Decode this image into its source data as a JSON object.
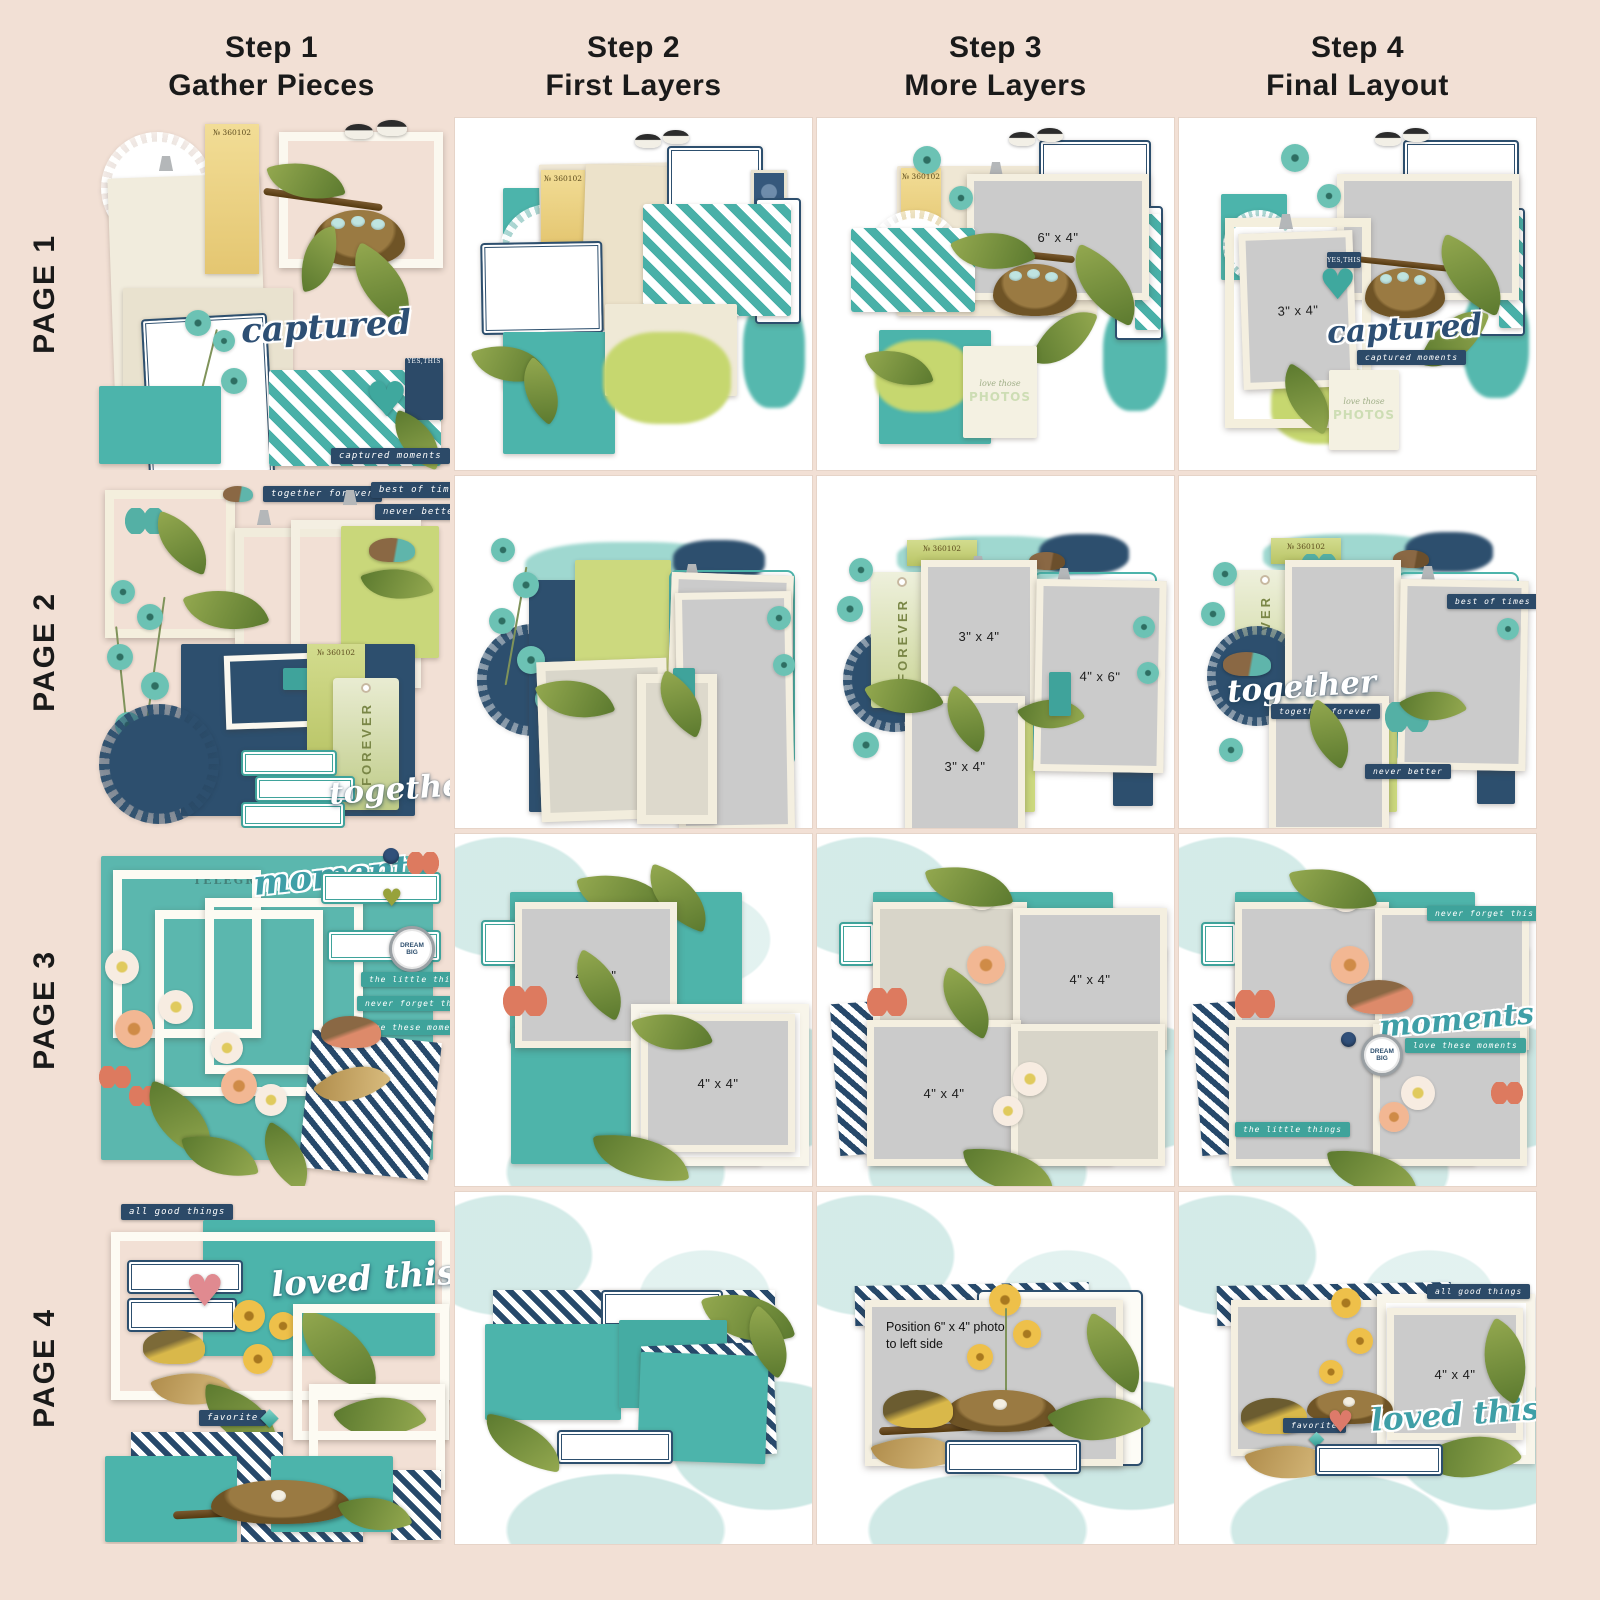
{
  "headers": [
    {
      "step": "Step 1",
      "title": "Gather Pieces"
    },
    {
      "step": "Step 2",
      "title": "First Layers"
    },
    {
      "step": "Step 3",
      "title": "More Layers"
    },
    {
      "step": "Step 4",
      "title": "Final Layout"
    }
  ],
  "row_labels": [
    "PAGE 1",
    "PAGE 2",
    "PAGE 3",
    "PAGE 4"
  ],
  "photo_sizes": {
    "s64": "6\" x 4\"",
    "s34": "3\" x 4\"",
    "s46": "4\" x 6\"",
    "s44": "4\" x 4\""
  },
  "strings": {
    "ticket_no": "№ 360102",
    "captured": "captured",
    "captured_moments": "captured moments",
    "yes_this": "YES,THIS",
    "love_those": "love those",
    "photos": "PHOTOS",
    "together": "together",
    "together_forever": "together forever",
    "best_of_times": "best of times",
    "never_better": "never better",
    "forever": "FOREVER",
    "moments": "moments",
    "little_things": "the little things",
    "never_forget": "never forget this",
    "love_these_moments": "love these moments",
    "dream_big": "DREAM BIG",
    "telegram": "TELEGRAMM",
    "all_good_things": "all good things",
    "loved_this": "loved this",
    "favorite": "favorite",
    "position_note": "Position 6\" x 4\" photo to left side"
  },
  "colors": {
    "background": "#f2e0d5",
    "teal": "#4cb3aa",
    "navy": "#2d4a66",
    "lime": "#c7d674",
    "cream": "#efe8d6",
    "photo_gray": "#cbcbcb",
    "wordart_teal": "#44a5ab",
    "coral": "#dd7a5f",
    "yellow": "#ecc04a"
  }
}
